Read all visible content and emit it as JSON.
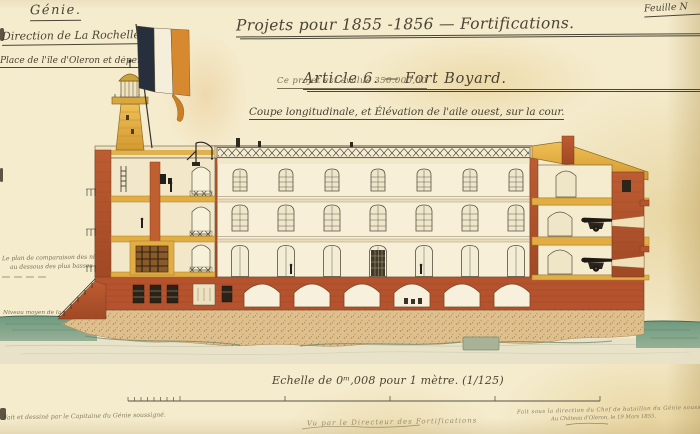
{
  "header": {
    "corps": "Génie.",
    "direction": "Direction de La Rochelle.",
    "place": "Place de l'île d'Oleron et dépendances.",
    "sheet_label": "Feuille N"
  },
  "title_block": {
    "project_line": "Projets pour 1855 -1856 — Fortifications.",
    "article_line": "Article 6. — Fort Boyard.",
    "estimate_line": "Ce projet est évalué 350.000,00",
    "view_caption": "Coupe longitudinale, et Élévation de l'aile ouest, sur la cour."
  },
  "annotations": {
    "datum_line1": "Le plan de comparaison des nivellements passe",
    "datum_line2": "au dessous des plus basses mers.",
    "sea_level": "Niveau moyen de la mer."
  },
  "scale_block": {
    "scale_label": "Echelle de 0ᵐ,008 pour 1 mètre. (1/125)"
  },
  "signatures": {
    "left": "Fait et dessiné par le Capitaine du Génie soussigné.",
    "center": "Vu par le Directeur des Fortifications",
    "right_line1": "Fait sous la direction du Chef de bataillon du Génie soussigné",
    "right_line2": "Au Château d'Oleron, le 19 Mars 1855."
  },
  "palette": {
    "paper": "#f2e8c6",
    "ink": "#4a4434",
    "faded_ink": "#8a7c60",
    "brick_red": "#b4532d",
    "ochre_yellow": "#e2ae44",
    "facade_cream": "#f7efd7",
    "sea_green": "#7aa287",
    "sand": "#dec08f",
    "flag_navy": "#272e3c",
    "flag_white": "#f4eedb",
    "flag_orange": "#d6892f"
  }
}
